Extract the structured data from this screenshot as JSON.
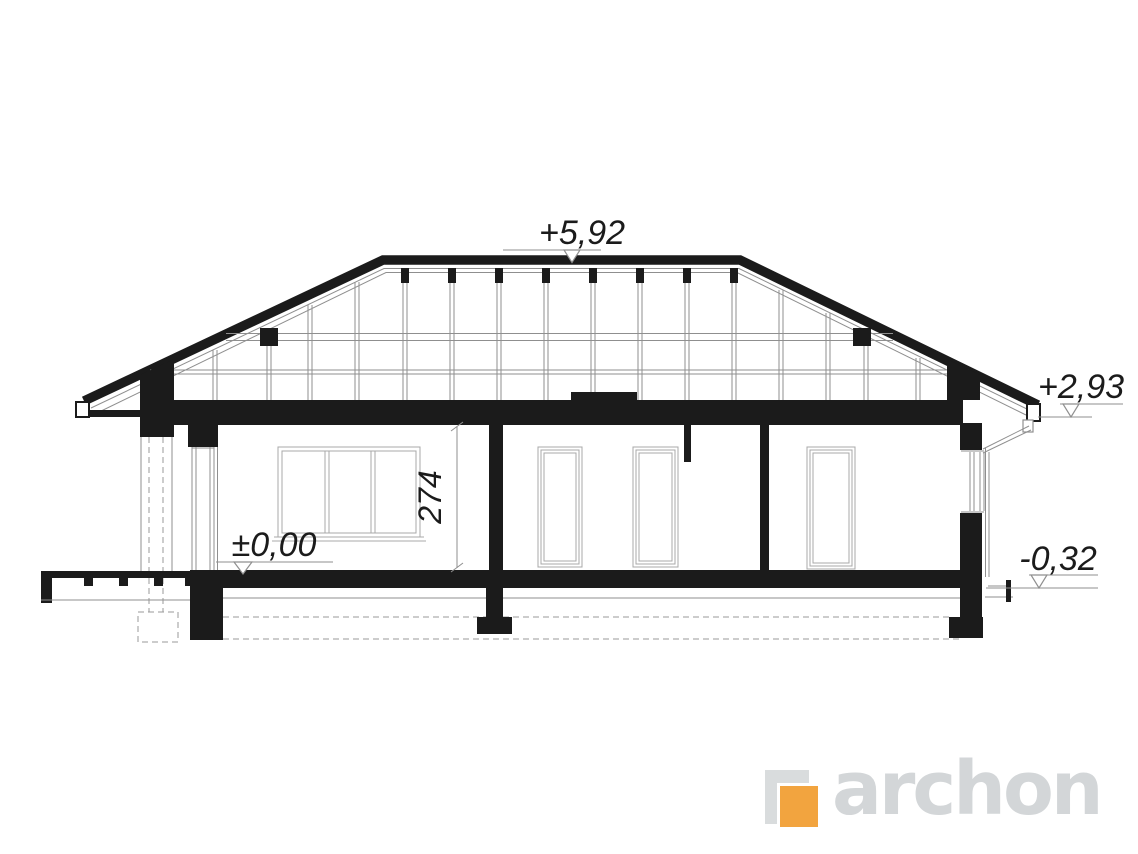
{
  "section_drawing": {
    "levels": {
      "ridge": "+5,92",
      "eave": "+2,93",
      "ground_floor": "±0,00",
      "terrace": "-0,32"
    },
    "dimensions": {
      "interior_height": "274"
    },
    "colors": {
      "ink": "#1B1B1B",
      "thin_line": "#8F8F8F"
    }
  },
  "branding": {
    "logo_text": "archon",
    "logo_orange": "#F2A43F",
    "logo_gray": "#D3D6D8"
  }
}
